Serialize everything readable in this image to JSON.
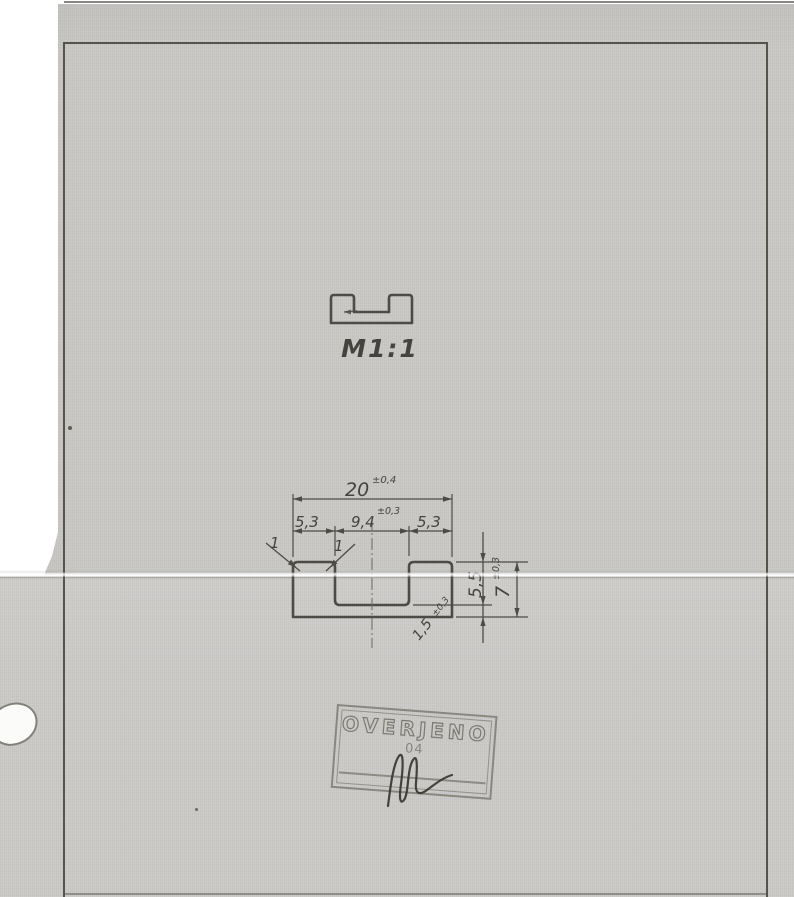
{
  "drawing": {
    "scale_label": "M1:1",
    "dimensions": {
      "total_width": "20",
      "total_width_tol": "±0,4",
      "flange_left": "5,3",
      "groove_width": "9,4",
      "groove_width_tol": "±0,3",
      "flange_right": "5,3",
      "chamfer_left": "1",
      "chamfer_right": "1",
      "groove_depth": "5,5",
      "total_height": "7",
      "total_height_tol": "±0,3",
      "base_thickness": "1,5",
      "base_thickness_tol": "±0,3"
    },
    "stamp": {
      "title": "OVERJENO",
      "number": "04"
    },
    "colors": {
      "paper": "#c9c8c5",
      "ink": "#4d4b45",
      "stamp_ink": "#82807a"
    }
  }
}
